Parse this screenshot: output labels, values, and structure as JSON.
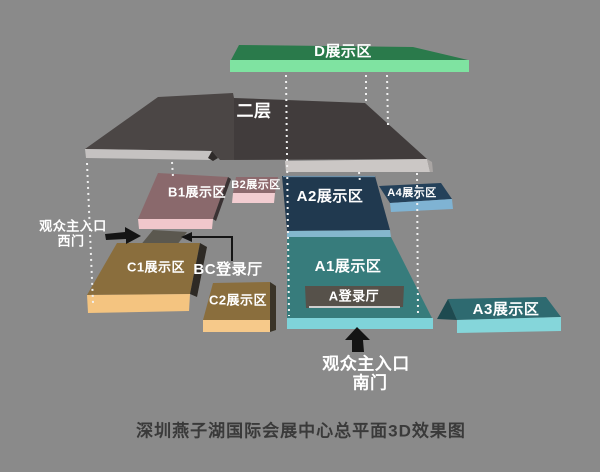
{
  "background": "#8a8a8a",
  "caption": {
    "text": "深圳燕子湖国际会展中心总平面3D效果图",
    "color": "#3a3a3a"
  },
  "areas": {
    "d": {
      "label": "D展示区",
      "top": "#2a7a4b",
      "front": "#7fe3a1"
    },
    "floor2": {
      "label": "二层",
      "top": "#4b4645",
      "front_left": "#c5c2c1",
      "front_right": "#cbc7c5",
      "step_shadow": "#2f2b2a",
      "end_cap": "#a9a5a3"
    },
    "b1": {
      "label": "B1展示区",
      "top": "#8a696c",
      "front": "#f0c7cb",
      "side": "#3a3233"
    },
    "b2": {
      "label": "B2展示区",
      "top": "#8d6a6e",
      "front": "#f2cdd1"
    },
    "a2": {
      "label": "A2展示区",
      "top": "#20394f",
      "front": "#84b7cd",
      "edge_highlight": "#6c8fa8"
    },
    "a4": {
      "label": "A4展示区",
      "top": "#24415a",
      "front": "#7fb3d3"
    },
    "a1": {
      "label": "A1展示区",
      "top": "#377c7c",
      "front": "#7fd3d9"
    },
    "a3": {
      "label": "A3展示区",
      "top": "#2e6a70",
      "front": "#85d6da",
      "side": "#1e4a50"
    },
    "c1": {
      "label": "C1展示区",
      "top": "#8a6e3d",
      "front": "#f4c480",
      "side": "#2e2a25"
    },
    "c2": {
      "label": "C2展示区",
      "top": "#8a6e3d",
      "front": "#f6c98a",
      "side": "#3a3428"
    },
    "a_hall": {
      "label": "A登录厅",
      "fill": "#56514a",
      "underline": "#cfcfcf"
    },
    "bc_hall": {
      "label": "BC登录厅"
    }
  },
  "entrances": {
    "west": {
      "line1": "观众主入口",
      "line2": "西门"
    },
    "south": {
      "line1": "观众主入口",
      "line2": "南门"
    }
  },
  "colors": {
    "dotted_line": "#f0f0f0",
    "arrow": "#141414",
    "walkway": "#5b584f",
    "pointer_line": "#141414",
    "floor2_shade": "#000000"
  }
}
